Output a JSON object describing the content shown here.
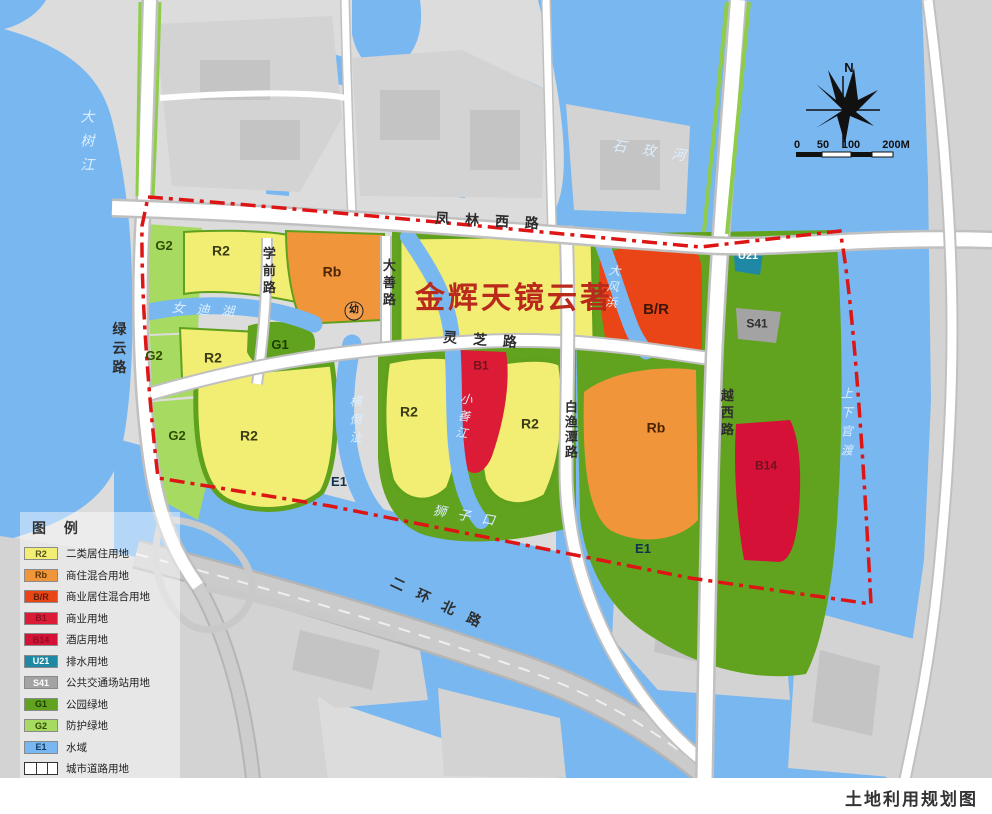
{
  "app": {
    "caption": "土地利用规划图"
  },
  "map": {
    "title_overlay": "金辉天镜云著",
    "colors": {
      "water": "#79b7f0",
      "r2": "#f2ee74",
      "rb": "#f0953a",
      "br": "#ea4517",
      "b1": "#dc1c36",
      "b14": "#d61138",
      "u21": "#1f89a5",
      "s41": "#a3a3a3",
      "g1": "#61a31e",
      "g2": "#a7da60",
      "boundary": "#dd1515",
      "title": "#b9291c"
    },
    "legend": {
      "title": "图 例",
      "items": [
        {
          "code": "R2",
          "label": "二类居住用地",
          "color": "#f2ee74",
          "text_color": "#55511a"
        },
        {
          "code": "Rb",
          "label": "商住混合用地",
          "color": "#f0953a",
          "text_color": "#5c3300"
        },
        {
          "code": "B/R",
          "label": "商业居住混合用地",
          "color": "#ea4517",
          "text_color": "#5c1e08"
        },
        {
          "code": "B1",
          "label": "商业用地",
          "color": "#dc1c36",
          "text_color": "#8c0f22"
        },
        {
          "code": "B14",
          "label": "酒店用地",
          "color": "#d61138",
          "text_color": "#8c0f22"
        },
        {
          "code": "U21",
          "label": "排水用地",
          "color": "#1f89a5",
          "text_color": "#ffffff"
        },
        {
          "code": "S41",
          "label": "公共交通场站用地",
          "color": "#a3a3a3",
          "text_color": "#ffffff"
        },
        {
          "code": "G1",
          "label": "公园绿地",
          "color": "#61a31e",
          "text_color": "#1d3a00"
        },
        {
          "code": "G2",
          "label": "防护绿地",
          "color": "#a7da60",
          "text_color": "#2c4a00"
        },
        {
          "code": "E1",
          "label": "水域",
          "color": "#79b7f0",
          "text_color": "#123a63"
        },
        {
          "code": "ROAD",
          "label": "城市道路用地",
          "type": "road"
        },
        {
          "code": "BOUNDARY",
          "label": "规划范围",
          "type": "boundary",
          "color": "#dd1515"
        }
      ]
    },
    "labels": [
      {
        "n": "road-label-fenglin-west",
        "t": "凤 林 西 路",
        "x": 490,
        "y": 221,
        "s": 14,
        "c": "#2d2d2d",
        "w": 700,
        "sp": 6,
        "r": 3
      },
      {
        "n": "road-label-lingzhi",
        "t": "灵 芝 路",
        "x": 483,
        "y": 340,
        "s": 14,
        "c": "#2d2d2d",
        "w": 700,
        "sp": 6,
        "r": 4
      },
      {
        "n": "road-label-erhuan-north",
        "t": "二 环 北 路",
        "x": 438,
        "y": 603,
        "s": 14,
        "c": "#2d2d2d",
        "w": 700,
        "sp": 5,
        "r": 25
      },
      {
        "n": "road-label-lvyun",
        "t": "绿云路",
        "x": 119,
        "y": 350,
        "s": 14,
        "c": "#2d2d2d",
        "w": 700,
        "sp": 5,
        "v": 1
      },
      {
        "n": "road-label-xueqian",
        "t": "学前路",
        "x": 268,
        "y": 272,
        "s": 13,
        "c": "#2d2d2d",
        "w": 700,
        "sp": 4,
        "v": 1
      },
      {
        "n": "road-label-dashan",
        "t": "大善路",
        "x": 388,
        "y": 284,
        "s": 13,
        "c": "#2d2d2d",
        "w": 700,
        "sp": 4,
        "v": 1
      },
      {
        "n": "road-label-baiyutan",
        "t": "白渔潭路",
        "x": 570,
        "y": 430,
        "s": 13,
        "c": "#2d2d2d",
        "w": 700,
        "sp": 2,
        "v": 1
      },
      {
        "n": "road-label-yuexi",
        "t": "越西路",
        "x": 726,
        "y": 414,
        "s": 13,
        "c": "#2d2d2d",
        "w": 700,
        "sp": 4,
        "v": 1
      },
      {
        "n": "water-label-dashu-river",
        "t": "大树江",
        "x": 87,
        "y": 145,
        "s": 14,
        "sp": 10,
        "v": 1,
        "i": 1
      },
      {
        "n": "water-label-shimei-river",
        "t": "石 玫 河",
        "x": 652,
        "y": 151,
        "s": 14,
        "sp": 6,
        "r": 8,
        "i": 1
      },
      {
        "n": "water-label-nvdi-lake",
        "t": "女 迪 湖",
        "x": 205,
        "y": 310,
        "s": 13,
        "sp": 4,
        "r": 4,
        "i": 1
      },
      {
        "n": "water-label-hengdao",
        "t": "横倒沚",
        "x": 355,
        "y": 422,
        "s": 12,
        "sp": 6,
        "v": 1,
        "i": 1
      },
      {
        "n": "water-label-xiaoshan-river",
        "t": "小善江",
        "x": 463,
        "y": 418,
        "s": 12,
        "sp": 5,
        "v": 1,
        "r": 8,
        "i": 1
      },
      {
        "n": "water-label-dafeng",
        "t": "大风浜",
        "x": 612,
        "y": 288,
        "s": 12,
        "sp": 4,
        "v": 1,
        "r": 6,
        "i": 1
      },
      {
        "n": "water-label-shizikou",
        "t": "狮 子 口",
        "x": 466,
        "y": 516,
        "s": 13,
        "sp": 4,
        "r": 10,
        "i": 1
      },
      {
        "n": "water-label-shangxia-guandu",
        "t": "上下官渡",
        "x": 846,
        "y": 425,
        "s": 12,
        "sp": 7,
        "v": 1,
        "i": 1
      },
      {
        "n": "parcel-label-g2",
        "t": "G2",
        "x": 164,
        "y": 246,
        "s": 13,
        "c": "#2f4d00",
        "w": 700
      },
      {
        "n": "parcel-label-r2",
        "t": "R2",
        "x": 221,
        "y": 251,
        "s": 14,
        "c": "#3c3c14",
        "w": 700
      },
      {
        "n": "parcel-label-rb",
        "t": "Rb",
        "x": 332,
        "y": 272,
        "s": 14,
        "c": "#4a2400",
        "w": 700
      },
      {
        "n": "parcel-label-g2",
        "t": "G2",
        "x": 154,
        "y": 356,
        "s": 13,
        "c": "#2f4d00",
        "w": 700
      },
      {
        "n": "parcel-label-r2",
        "t": "R2",
        "x": 213,
        "y": 358,
        "s": 14,
        "c": "#3c3c14",
        "w": 700
      },
      {
        "n": "parcel-label-g1",
        "t": "G1",
        "x": 280,
        "y": 345,
        "s": 13,
        "c": "#1c3a00",
        "w": 700
      },
      {
        "n": "parcel-label-g2",
        "t": "G2",
        "x": 177,
        "y": 436,
        "s": 13,
        "c": "#2f4d00",
        "w": 700
      },
      {
        "n": "parcel-label-r2",
        "t": "R2",
        "x": 249,
        "y": 436,
        "s": 14,
        "c": "#3c3c14",
        "w": 700
      },
      {
        "n": "parcel-label-r2",
        "t": "R2",
        "x": 409,
        "y": 412,
        "s": 14,
        "c": "#3c3c14",
        "w": 700
      },
      {
        "n": "parcel-label-r2",
        "t": "R2",
        "x": 530,
        "y": 424,
        "s": 14,
        "c": "#3c3c14",
        "w": 700
      },
      {
        "n": "parcel-label-b1",
        "t": "B1",
        "x": 481,
        "y": 366,
        "s": 12,
        "c": "#70121d",
        "w": 700
      },
      {
        "n": "parcel-label-br",
        "t": "B/R",
        "x": 656,
        "y": 310,
        "s": 15,
        "c": "#3d1405",
        "w": 700
      },
      {
        "n": "parcel-label-rb",
        "t": "Rb",
        "x": 656,
        "y": 428,
        "s": 14,
        "c": "#4a2400",
        "w": 700
      },
      {
        "n": "parcel-label-b14",
        "t": "B14",
        "x": 766,
        "y": 466,
        "s": 12,
        "c": "#70121d",
        "w": 700
      },
      {
        "n": "parcel-label-u21",
        "t": "U21",
        "x": 748,
        "y": 257,
        "s": 11,
        "c": "#ffffff",
        "w": 700
      },
      {
        "n": "parcel-label-s41",
        "t": "S41",
        "x": 757,
        "y": 324,
        "s": 12,
        "c": "#2f2f2f",
        "w": 700
      },
      {
        "n": "parcel-label-e1",
        "t": "E1",
        "x": 339,
        "y": 482,
        "s": 13,
        "c": "#11324f",
        "w": 700
      },
      {
        "n": "parcel-label-e1",
        "t": "E1",
        "x": 643,
        "y": 549,
        "s": 13,
        "c": "#11324f",
        "w": 700
      },
      {
        "n": "kindergarten-symbol",
        "t": "幼",
        "x": 354,
        "y": 311,
        "s": 10,
        "c": "#1a1a1a",
        "w": 700,
        "circle": 1
      },
      {
        "n": "north-label",
        "t": "N",
        "x": 849,
        "y": 68,
        "s": 13,
        "c": "#111111",
        "w": 700
      },
      {
        "n": "scale-tick",
        "t": "0",
        "x": 797,
        "y": 146,
        "s": 11,
        "c": "#111111",
        "w": 700
      },
      {
        "n": "scale-tick",
        "t": "50",
        "x": 823,
        "y": 146,
        "s": 11,
        "c": "#111111",
        "w": 700
      },
      {
        "n": "scale-tick",
        "t": "100",
        "x": 851,
        "y": 146,
        "s": 11,
        "c": "#111111",
        "w": 700
      },
      {
        "n": "scale-tick",
        "t": "200M",
        "x": 896,
        "y": 146,
        "s": 11,
        "c": "#111111",
        "w": 700
      }
    ]
  }
}
